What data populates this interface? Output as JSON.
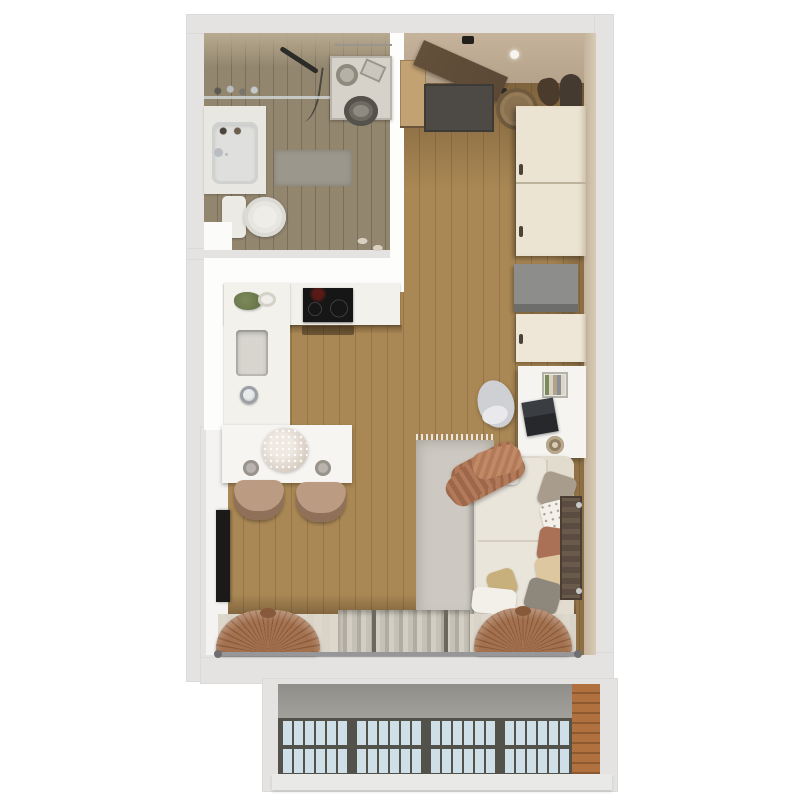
{
  "scene": {
    "kind": "3d-floor-plan-top-view",
    "subject": "studio apartment render with bathroom, entry hall, kitchen, living/work area and a glazed atrium roof below the window wall"
  },
  "rooms": [
    {
      "id": "bathroom"
    },
    {
      "id": "entry-hall"
    },
    {
      "id": "kitchen"
    },
    {
      "id": "living-area"
    },
    {
      "id": "atrium-roof"
    }
  ],
  "furniture": {
    "bathroom": [
      "wall-shelf-bottles",
      "washbasin",
      "basin-faucet",
      "toilet",
      "bath-mat",
      "washing-machine",
      "laundry-basket",
      "detergent-box",
      "towel-rail",
      "shower-set",
      "slippers"
    ],
    "entry": [
      "entry-door",
      "doormat",
      "shoe-cabinet",
      "shoes",
      "storage-basket",
      "wall-mirror",
      "coat",
      "ceiling-light",
      "tall-wardrobe"
    ],
    "kitchen": [
      "l-shaped-counter",
      "cooktop",
      "oven-shadow",
      "kitchen-sink",
      "kitchen-faucet",
      "herb-plant",
      "bowl",
      "dining-table",
      "flower-bouquet",
      "plate",
      "plate",
      "dining-chair",
      "dining-chair",
      "wall-tv"
    ],
    "living": [
      "gray-cabinet",
      "cream-cabinet",
      "desk",
      "laptop",
      "desk-organizer",
      "mug",
      "office-chair",
      "sofa",
      "throw-blanket",
      "area-rug",
      "radiator",
      "pillows"
    ],
    "window-wall": [
      "window-bench",
      "sheer-curtain",
      "tied-drape-left",
      "tied-drape-right",
      "curtain-rod"
    ],
    "atrium": [
      "concrete-parapet",
      "skylight-panel",
      "skylight-panel",
      "skylight-panel",
      "skylight-panel",
      "brick-pillar",
      "sill"
    ]
  },
  "colors": {
    "wall": "#e4e3e1",
    "inner-white": "#fdfdfc",
    "bath-floor": "#92866f",
    "bath-wall": "#b9ab91",
    "oak-floor": "#aa8855",
    "entry-wall": "#c6b39b",
    "counter": "#f3f1ec",
    "cooktop": "#161616",
    "sink-recess": "#d8d5cf",
    "chrome": "#b9bdc1",
    "table": "#f6f5f2",
    "chair-tan": "#bb9b81",
    "chair-tan-dark": "#8f7058",
    "tv": "#1c1a18",
    "doormat": "#4d4945",
    "door": "#5b4836",
    "shoe-cabinet": "#c2a172",
    "basket": "#8a7150",
    "mirror": "#453a2f",
    "wardrobe": "#ece4d2",
    "wardrobe-shadow": "#c9bda6",
    "cabinet-gray": "#8d8d8b",
    "cabinet-cream": "#eee7d7",
    "desk": "#f5f4f1",
    "laptop": "#26282c",
    "chair-gray": "#cfd0d4",
    "sofa": "#eae5db",
    "sofa-line": "#d4cec1",
    "rug": "#cdc9c2",
    "rug-fringe": "#e9e5df",
    "throw": "#b37a5a",
    "throw-dark": "#9c674a",
    "pillow-taupe": "#a89c8d",
    "pillow-white": "#f3f0e9",
    "pillow-rust": "#ab7156",
    "pillow-tan": "#ddc7a1",
    "pillow-gray": "#8e877b",
    "pillow-khaki": "#c8b07d",
    "radiator": "#5a4c40",
    "bench": "#d9d3c8",
    "sheer": "#c5c1b6",
    "drape": "#a4714e",
    "drape-dark": "#875a3c",
    "rod": "#97979a",
    "concrete": "#a3a19c",
    "glass": "#cfdfe8",
    "frame": "#52514a",
    "brick": "#b0713f",
    "brick-dark": "#8d5a30",
    "washer": "#d6d2ca",
    "plant": "#7c8a5a",
    "flower": "#ded5cb"
  }
}
